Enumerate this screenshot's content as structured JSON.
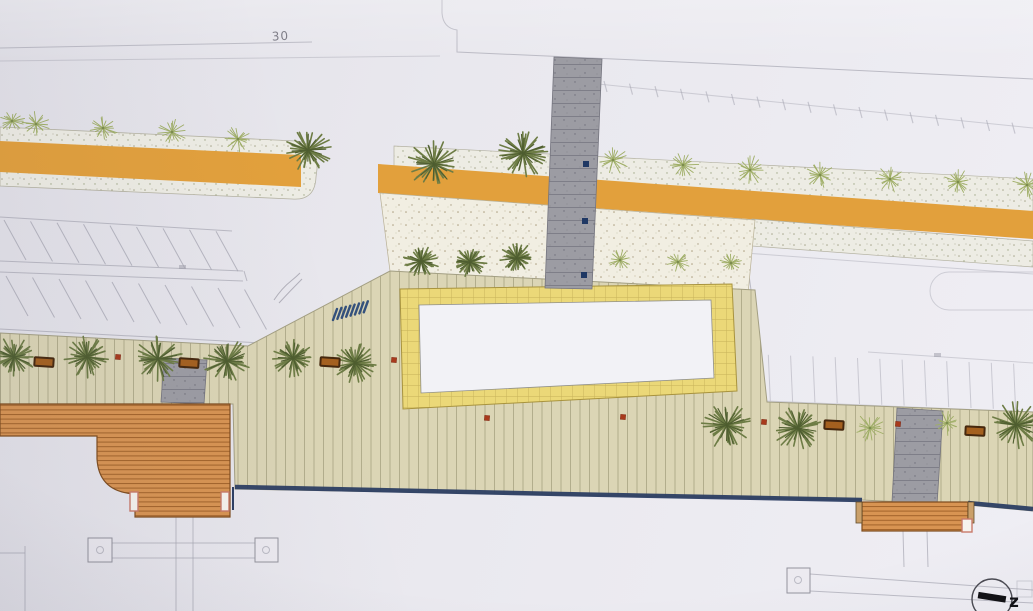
{
  "labels": {
    "dim_30": "30",
    "marker_z": "z"
  },
  "colors": {
    "paper": "#e8e7ed",
    "line_faint": "#a6a6b2",
    "orange_band": "#e2a03c",
    "plant_bg": "#edece4",
    "sand_bg": "#f1eee2",
    "promenade": "#dbd5b5",
    "promenade_stripe": "#b2ad8c",
    "plaza_fill": "#ebd878",
    "plaza_grid": "#c6b158",
    "plaza_inner": "#f2f2f6",
    "crosswalk": "#9c9ca3",
    "deck": "#d89452",
    "deck_stripe": "#a2632a",
    "seawall": "#2c3e63",
    "palm_dark": "#4f5e30",
    "palm_mid": "#6d7c45",
    "grass": "#9fae66",
    "grass_dark": "#7c8c4e",
    "bench_fill": "#a4601f",
    "bench_border": "#46280e",
    "dot_red": "#a83a1c",
    "dot_navy": "#1f3864",
    "ramp_blue": "#2c4a7a",
    "marker_black": "#101014"
  },
  "plan": {
    "palms": [
      [
        14,
        357,
        22
      ],
      [
        87,
        357,
        23
      ],
      [
        158,
        359,
        26
      ],
      [
        227,
        361,
        24
      ],
      [
        293,
        358,
        21
      ],
      [
        355,
        363,
        22
      ],
      [
        308,
        150,
        24
      ],
      [
        434,
        164,
        27
      ],
      [
        523,
        153,
        27
      ],
      [
        421,
        261,
        18
      ],
      [
        470,
        262,
        17
      ],
      [
        517,
        258,
        17
      ],
      [
        727,
        425,
        27
      ],
      [
        798,
        428,
        25
      ],
      [
        1016,
        425,
        26
      ]
    ],
    "tufts": [
      [
        12,
        121,
        13
      ],
      [
        36,
        124,
        14
      ],
      [
        103,
        128,
        15
      ],
      [
        172,
        132,
        15
      ],
      [
        238,
        139,
        15
      ],
      [
        613,
        160,
        16
      ],
      [
        683,
        165,
        16
      ],
      [
        750,
        170,
        17
      ],
      [
        820,
        175,
        16
      ],
      [
        890,
        179,
        16
      ],
      [
        958,
        182,
        15
      ],
      [
        1027,
        185,
        16
      ],
      [
        620,
        260,
        12
      ],
      [
        678,
        262,
        12
      ],
      [
        731,
        263,
        12
      ],
      [
        870,
        428,
        17
      ],
      [
        947,
        423,
        14
      ]
    ],
    "benches": [
      [
        44,
        362,
        4
      ],
      [
        189,
        363,
        4
      ],
      [
        330,
        362,
        4
      ],
      [
        834,
        425,
        3
      ],
      [
        975,
        431,
        3
      ]
    ],
    "red_dots": [
      [
        118,
        357
      ],
      [
        394,
        360
      ],
      [
        487,
        418
      ],
      [
        623,
        417
      ],
      [
        764,
        422
      ],
      [
        898,
        424
      ]
    ],
    "navy_dots": [
      [
        586,
        164
      ],
      [
        585,
        221
      ],
      [
        584,
        275
      ]
    ],
    "parking_upper": {
      "count": 9,
      "x0": 4,
      "y0": 220,
      "dx": 26.5,
      "dy": 1.4,
      "ux": 22,
      "uy": 40
    },
    "parking_lower": {
      "count": 10,
      "x0": 6,
      "y0": 276,
      "dx": 26.5,
      "dy": 1.5,
      "ux": 22,
      "uy": 40
    },
    "stalls_right": {
      "count": 13,
      "x0": 746,
      "y0": 354,
      "dx": 22.3,
      "dy": 0.8,
      "ux": 2,
      "uy": 46
    },
    "lane_ticks": {
      "count": 17,
      "x0": 604,
      "y0": 81,
      "dx": 25.5,
      "dy": 2.6,
      "ux": 3,
      "uy": 11
    },
    "ramp_bars": {
      "count": 8,
      "x0": 333,
      "y0": 320,
      "dx": 4.4,
      "dy": -1.1,
      "ux": 4,
      "uy": -11
    }
  }
}
